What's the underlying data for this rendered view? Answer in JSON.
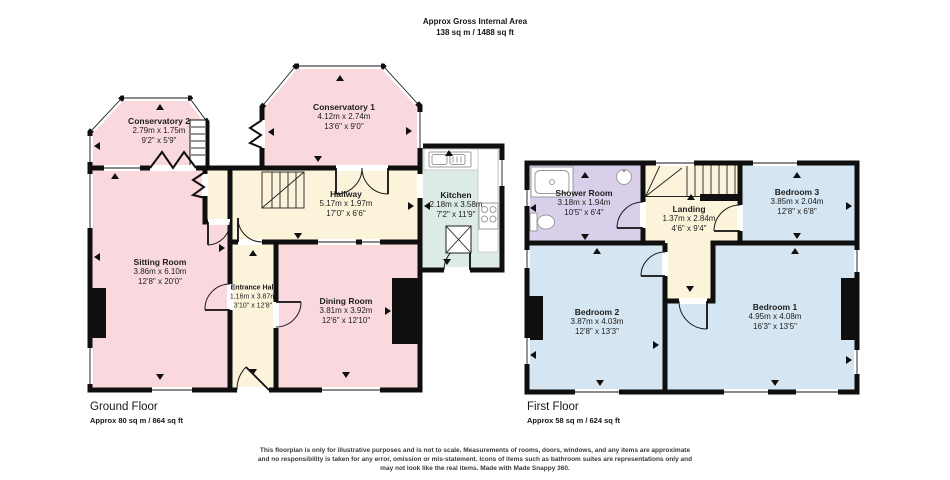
{
  "header": {
    "title": "Approx Gross Internal Area",
    "subtitle": "138 sq m / 1488 sq ft"
  },
  "ground_floor": {
    "title": "Ground Floor",
    "area": "Approx 80 sq m / 864 sq ft",
    "rooms": {
      "conservatory_2": {
        "name": "Conservatory 2",
        "size_m": "2.79m x 1.75m",
        "size_ft": "9'2\" x 5'9\""
      },
      "conservatory_1": {
        "name": "Conservatory 1",
        "size_m": "4.12m x 2.74m",
        "size_ft": "13'6\" x 9'0\""
      },
      "hallway": {
        "name": "Hallway",
        "size_m": "5.17m x 1.97m",
        "size_ft": "17'0\" x 6'6\""
      },
      "kitchen": {
        "name": "Kitchen",
        "size_m": "2.18m x 3.58m",
        "size_ft": "7'2\" x 11'9\""
      },
      "sitting_room": {
        "name": "Sitting Room",
        "size_m": "3.86m x 6.10m",
        "size_ft": "12'8\" x 20'0\""
      },
      "entrance_hall": {
        "name": "Entrance Hall",
        "size_m": "1.16m x 3.87m",
        "size_ft": "3'10\" x 12'8\""
      },
      "dining_room": {
        "name": "Dining Room",
        "size_m": "3.81m x 3.92m",
        "size_ft": "12'6\" x 12'10\""
      }
    }
  },
  "first_floor": {
    "title": "First Floor",
    "area": "Approx 58 sq m / 624 sq ft",
    "rooms": {
      "shower_room": {
        "name": "Shower Room",
        "size_m": "3.18m x 1.94m",
        "size_ft": "10'5\" x 6'4\""
      },
      "landing": {
        "name": "Landing",
        "size_m": "1.37m x 2.84m",
        "size_ft": "4'6\" x 9'4\""
      },
      "bedroom_3": {
        "name": "Bedroom 3",
        "size_m": "3.85m x 2.04m",
        "size_ft": "12'8\" x 6'8\""
      },
      "bedroom_2": {
        "name": "Bedroom 2",
        "size_m": "3.87m x 4.03m",
        "size_ft": "12'8\" x 13'3\""
      },
      "bedroom_1": {
        "name": "Bedroom 1",
        "size_m": "4.95m x 4.08m",
        "size_ft": "16'3\" x 13'5\""
      }
    }
  },
  "disclaimer": {
    "line1": "This floorplan is only for illustrative purposes and is not to scale. Measurements of rooms, doors, windows, and any items are approximate",
    "line2": "and no responsibility is taken for any error, omission or mis-statement. Icons of items such as bathroom suites are representations only and",
    "line3": "may not look like the real items. Made with Made Snappy 360."
  },
  "palette": {
    "wall": "#0f0f0f",
    "room_pink": "#f9d9de",
    "room_cream": "#fbf3da",
    "room_mint": "#dcebe3",
    "room_lavender": "#d9cfea",
    "room_blue": "#d5e6f2"
  }
}
